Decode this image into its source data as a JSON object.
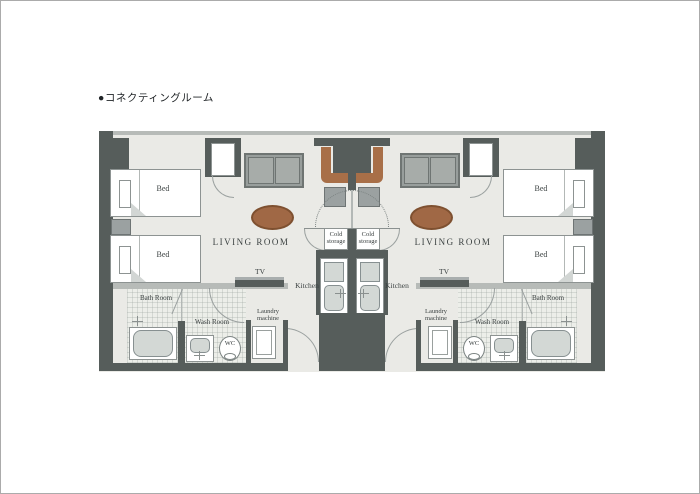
{
  "page": {
    "title": "●コネクティングルーム"
  },
  "room": {
    "bed": "Bed",
    "living_room": "LIVING ROOM",
    "tv": "TV",
    "kitchen": "Kitchen",
    "cold_storage": "Cold storage",
    "wash_room": "Wash Room",
    "bath_room": "Bath Room",
    "wc": "WC",
    "laundry_machine": "Laundry machine"
  },
  "colors": {
    "wall_dark": "#565d5b",
    "wall_light": "#b7bbb8",
    "floor": "#eaeae6",
    "wood_desk": "#a86f48",
    "wood_table": "#a06845",
    "furniture_gray": "#9ba1a1",
    "fixture_fill": "#d3d8d5",
    "text": "#3c4242"
  }
}
